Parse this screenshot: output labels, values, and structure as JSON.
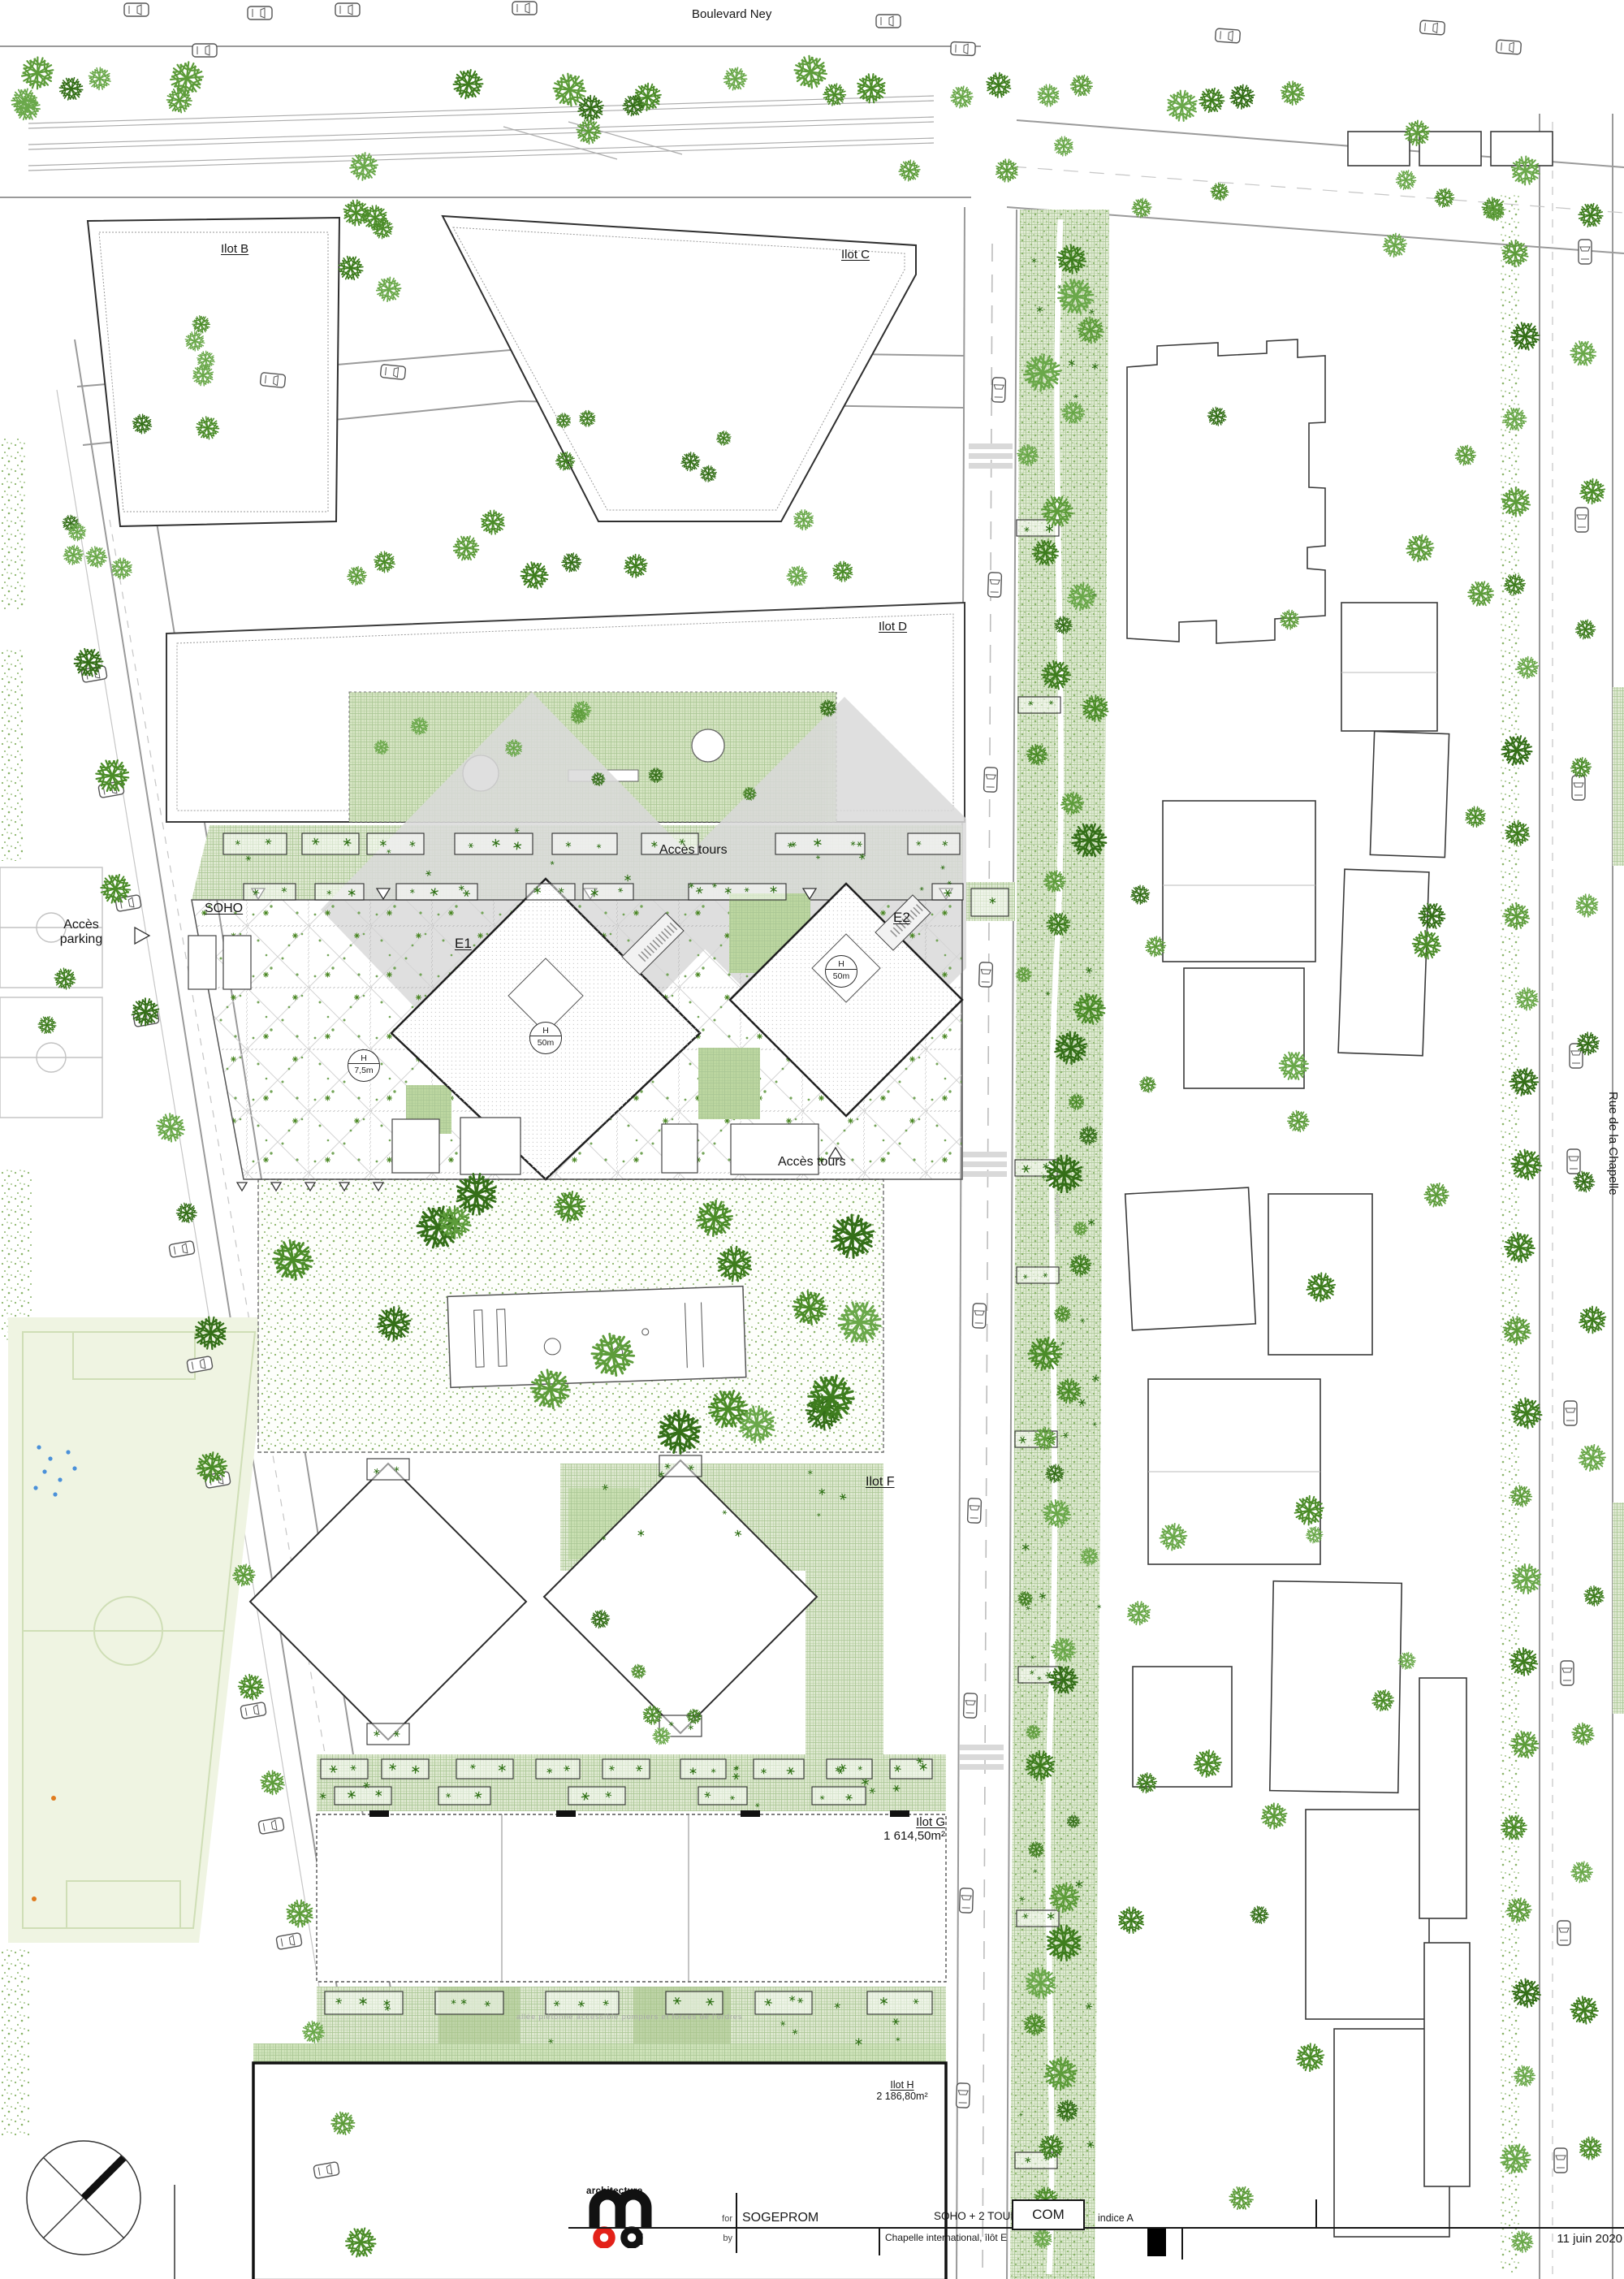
{
  "plan": {
    "street_top": "Boulevard Ney",
    "street_right": "Rue de la Chapelle",
    "blocks": {
      "b": "Ilot B",
      "c": "Ilot C",
      "d": "Ilot D",
      "f": "Ilot F",
      "g": "Ilot G",
      "g_area": "1 614,50m²",
      "h": "Ilot H",
      "h_area": "2 186,80m²"
    },
    "soho": "SOHO",
    "tower_e1": "E1",
    "tower_e2": "E2",
    "access_tours_top": "Accès tours",
    "access_tours_bottom": "Accès tours",
    "access_parking_line1": "Accès",
    "access_parking_line2": "parking",
    "heights": {
      "e1": [
        "H",
        "50m"
      ],
      "e2": [
        "H",
        "50m"
      ],
      "soho": [
        "H",
        "7,5m"
      ]
    },
    "fire_note": "allée piétonne accessible pompiers et forces de l'ordres",
    "park_lane": "voie pompiers"
  },
  "titleblock": {
    "for_label": "for",
    "by_label": "by",
    "client": "SOGEPROM",
    "project": "SOHO + 2 TOURS",
    "phase": "COM",
    "index_label": "indice A",
    "subtitle": "Chapelle international, îlôt E",
    "date": "11 juin 2020",
    "architecture": "architecture"
  },
  "colors": {
    "logo_red": "#e32119",
    "tree_green": "#4b8c28",
    "hatch_green": "#a9c693"
  }
}
